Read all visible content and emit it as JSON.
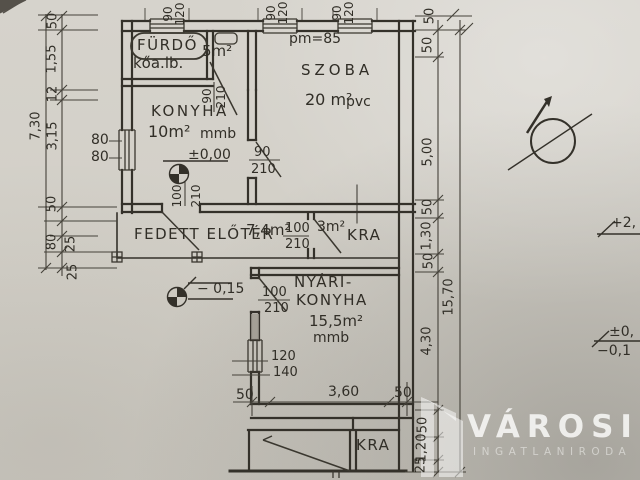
{
  "rooms": {
    "furdo_name": "FÜRDŐ",
    "furdo_note": "kőa.lb.",
    "hall_area": "5m²",
    "konyha_name": "KONYHA",
    "konyha_area": "10m²",
    "konyha_floor": "mmb",
    "szoba_pm": "pm=85",
    "szoba_name": "SZOBA",
    "szoba_area": "20 m²",
    "szoba_floor": "pvc",
    "eloter_name": "FEDETT ELŐTÉR",
    "eloter_area": "7,4m²",
    "kamra_area": "3m²",
    "kamra_name": "KRA",
    "nyari_name1": "NYÁRI-",
    "nyari_name2": "KONYHA",
    "nyari_area": "15,5m²",
    "nyari_floor": "mmb",
    "kra2_name": "KRA"
  },
  "levels": {
    "zero": "±0,00",
    "minus": "− 0,15",
    "edge1": "+2,",
    "edge2": "±0,",
    "edge3": "−0,1"
  },
  "openings": {
    "top_w": "90",
    "top_h": "120",
    "hall_w": "90",
    "hall_h": "210",
    "konyha_w": "90",
    "konyha_h": "210",
    "kdown_w": "100",
    "kdown_h": "210",
    "porch_w": "100",
    "porch_h": "210",
    "nyari_w": "100",
    "nyari_h": "210",
    "kwin_w": "80",
    "kwin_h": "80",
    "nwin_w": "120",
    "nwin_h": "140"
  },
  "dims": {
    "left": [
      "50",
      "1,55",
      "12",
      "3,15",
      "7,30",
      "50",
      "80",
      "25",
      "25"
    ],
    "top50": "50",
    "right": [
      "50",
      "5,00",
      "50",
      "1,30",
      "50",
      "15,70",
      "4,30",
      "50",
      "1,20",
      "25"
    ],
    "bottom": [
      "50",
      "3,60",
      "50"
    ]
  },
  "watermark": {
    "title": "VÁROSI",
    "subtitle": "INGATLANIRODA"
  }
}
